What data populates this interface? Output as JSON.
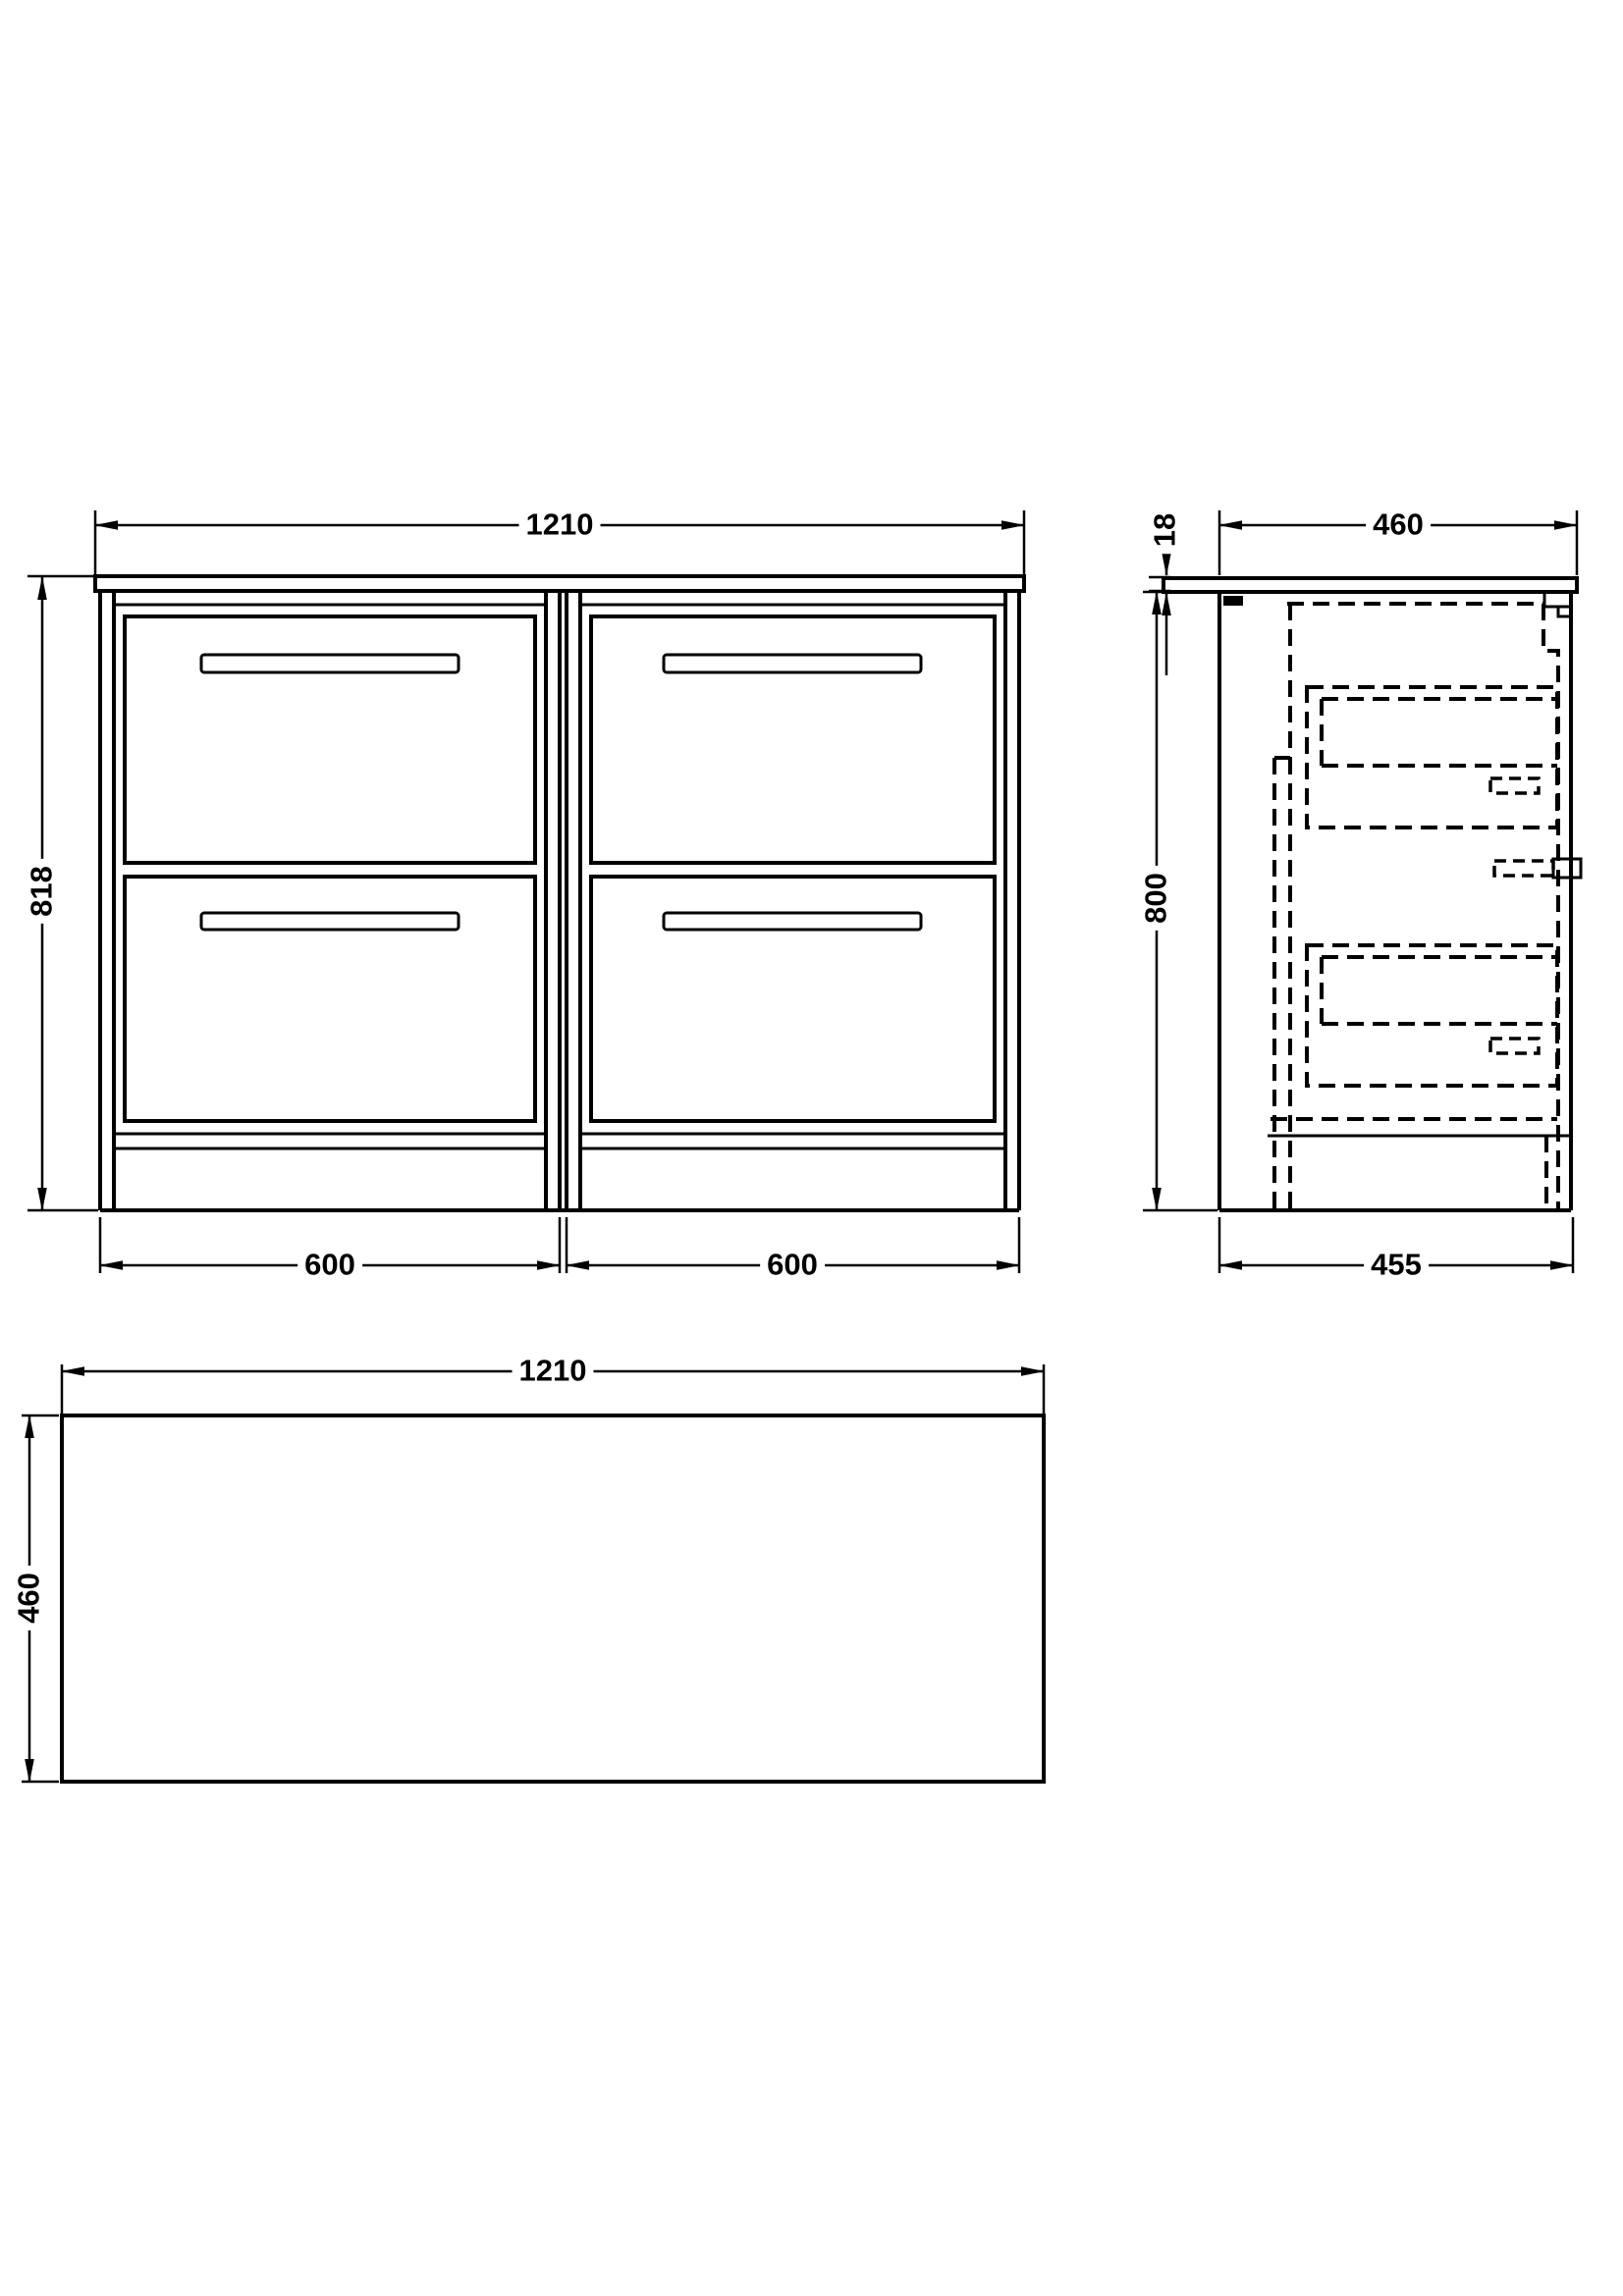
{
  "colors": {
    "background": "#ffffff",
    "line": "#000000"
  },
  "dimensions": {
    "front": {
      "width": "1210",
      "height": "818",
      "left_section": "600",
      "right_section": "600"
    },
    "side": {
      "worktop_thickness": "18",
      "depth_top": "460",
      "height": "800",
      "depth_bottom": "455"
    },
    "plan": {
      "width": "1210",
      "depth": "460"
    }
  }
}
